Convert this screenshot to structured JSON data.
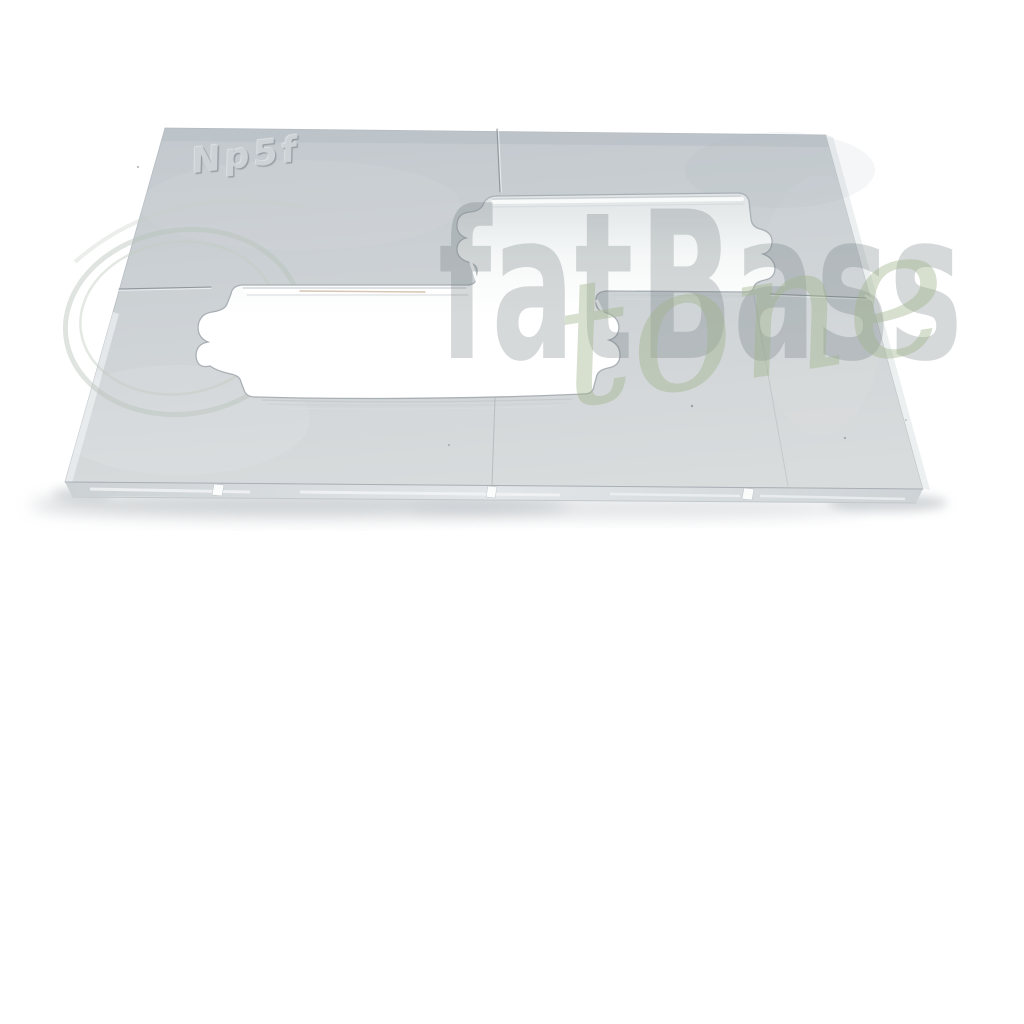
{
  "photo": {
    "background_color": "#ffffff",
    "subject": "clear acrylic pickup routing template"
  },
  "plate": {
    "engraving_label": "Np5f",
    "surface_color": "#cdd2d6",
    "edge_color": "#dfe3e5",
    "cutout_color": "#ffffff"
  },
  "watermark": {
    "brand_word_1": "fat",
    "brand_word_2": "Bass",
    "script_word": "tone",
    "block_color": "#6e767d",
    "script_color": "#a0b68c"
  }
}
